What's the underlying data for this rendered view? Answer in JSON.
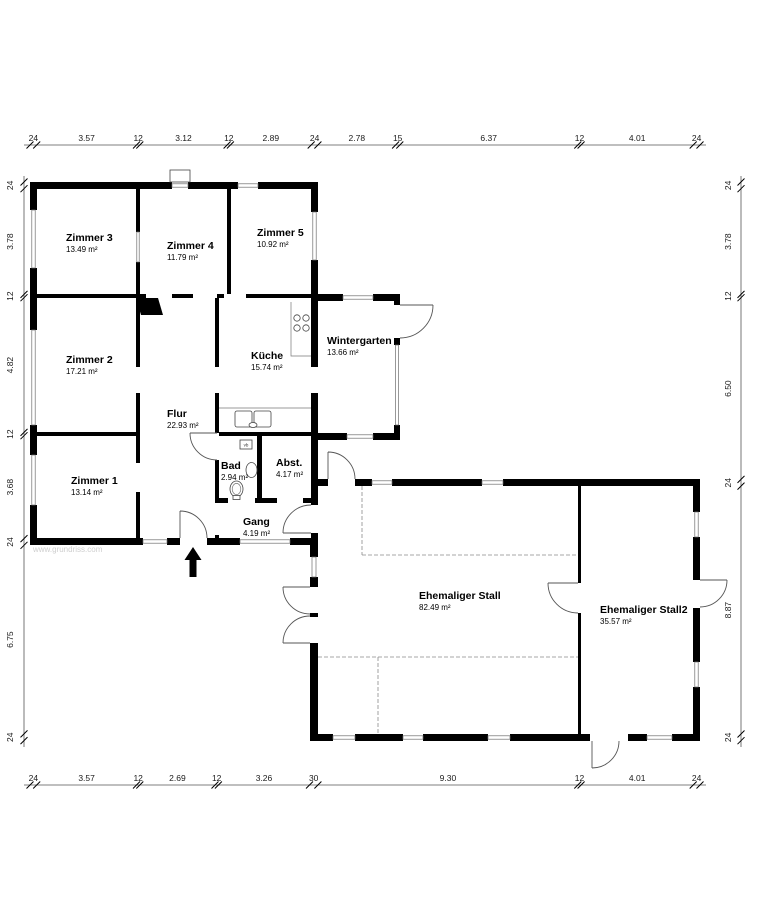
{
  "watermark": "www.grundriss.com",
  "rooms": [
    {
      "name": "Zimmer 3",
      "area": "13.49 m²"
    },
    {
      "name": "Zimmer 4",
      "area": "11.79 m²"
    },
    {
      "name": "Zimmer 5",
      "area": "10.92 m²"
    },
    {
      "name": "Zimmer 2",
      "area": "17.21 m²"
    },
    {
      "name": "Küche",
      "area": "15.74 m²"
    },
    {
      "name": "Wintergarten",
      "area": "13.66 m²"
    },
    {
      "name": "Flur",
      "area": "22.93 m²"
    },
    {
      "name": "Zimmer 1",
      "area": "13.14 m²"
    },
    {
      "name": "Bad",
      "area": "2.94 m²"
    },
    {
      "name": "Abst.",
      "area": "4.17 m²"
    },
    {
      "name": "Gang",
      "area": "4.19 m²"
    },
    {
      "name": "Ehemaliger Stall",
      "area": "82.49 m²"
    },
    {
      "name": "Ehemaliger Stall2",
      "area": "35.57 m²"
    }
  ],
  "dimensions": {
    "top": [
      "24",
      "3.57",
      "12",
      "3.12",
      "12",
      "2.89",
      "24",
      "2.78",
      "15",
      "6.37",
      "12",
      "4.01",
      "24"
    ],
    "bottom": [
      "24",
      "3.57",
      "12",
      "2.69",
      "12",
      "3.26",
      "30",
      "9.30",
      "12",
      "4.01",
      "24"
    ],
    "left": [
      "24",
      "3.78",
      "12",
      "4.82",
      "12",
      "3.68",
      "24",
      "6.75",
      "24"
    ],
    "right": [
      "24",
      "3.78",
      "12",
      "6.50",
      "24",
      "8.87",
      "24"
    ]
  },
  "fixtures": {
    "vent_label": "vb"
  },
  "icons": {
    "north_arrow": "up-arrow",
    "stove": "four-burner-circles",
    "kitchen_sink": "double-basin",
    "toilet": "wc-oval",
    "washbasin": "half-oval"
  },
  "colors": {
    "wall": "#000000",
    "background": "#ffffff",
    "dimension_text": "#1a1a1a",
    "watermark": "#cfcfcf"
  }
}
